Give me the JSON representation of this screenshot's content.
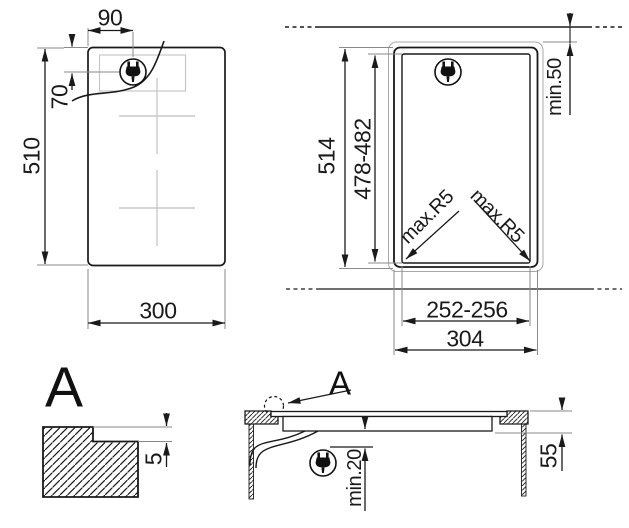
{
  "drawing_type": "hob-installation-diagram",
  "figures": {
    "top_view": {
      "width": "300",
      "height": "510",
      "plug_offset_x": "90",
      "plug_offset_y": "70"
    },
    "cutout_view": {
      "overall_width": "304",
      "overall_height": "514",
      "cutout_width": "252-256",
      "cutout_height": "478-482",
      "wall_clearance": "min.50",
      "corner_radius_left": "max.R5",
      "corner_radius_right": "max.R5"
    },
    "detail_view": {
      "label": "A",
      "rebate_depth": "5"
    },
    "section_view": {
      "detail_callout": "A",
      "clearance_below": "min.20",
      "depth_below_worktop": "55"
    }
  },
  "icons": {
    "plug": "power-plug-icon"
  },
  "colors": {
    "line": "#1a1a1a",
    "extension_gray": "#8a8a8a",
    "light_gray": "#c4c4c4",
    "background": "#ffffff"
  }
}
